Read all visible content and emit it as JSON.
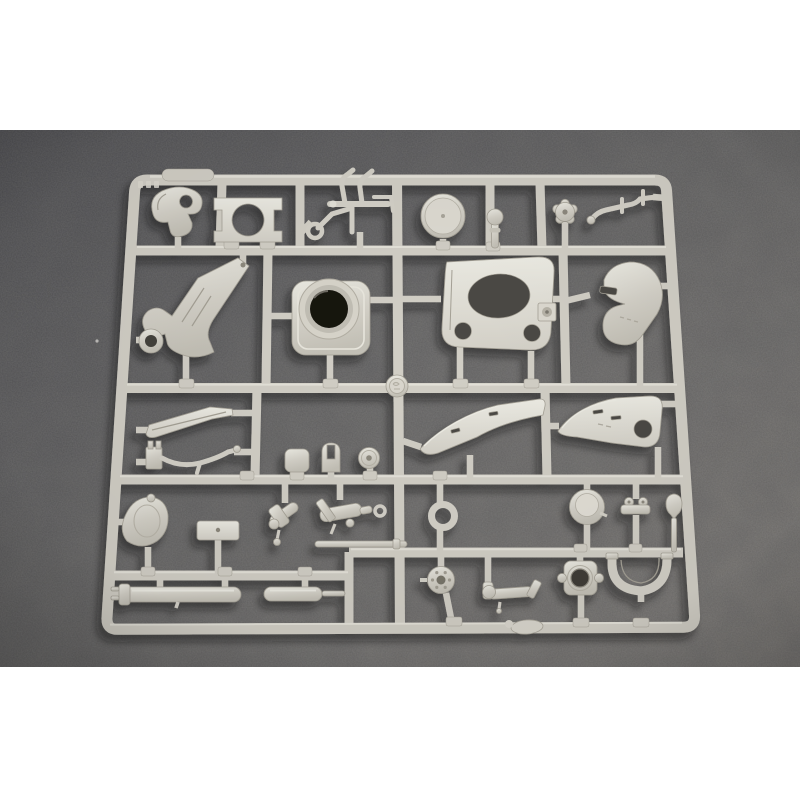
{
  "description": "Product photograph of a light grey injection-moulded plastic sprue (model kit parts tree) for a scale artillery/vehicle kit, lying on dark grey felt fabric; plain white bands above and below the photo. No readable text is visible, only an illegible embossed marking near the top-left of the frame.",
  "photo": {
    "subject": "plastic model kit sprue with unassembled parts",
    "background_material": "dark grey felt",
    "plastic_finish": "matte light grey styrene"
  },
  "colors": {
    "page_bg": "#ffffff",
    "felt_dark": "#505053",
    "felt_mid": "#696867",
    "felt_light": "#807d79",
    "plastic_hi": "#edece4",
    "plastic_base": "#d4d1c8",
    "plastic_mid": "#c4c1b7",
    "plastic_shadow": "#a5a196",
    "runner": "#d2cfc6",
    "runner_hi": "#e8e6dd",
    "hole_dark": "#181511",
    "cutout_dark": "#4b4944",
    "shadow": "#16150f"
  },
  "sprue": {
    "layout": "rectangular outer frame with one full-height centre runner, four horizontal runners and short attachment gates",
    "parts": [
      {
        "name": "molded-tab",
        "desc": "raised rounded tab on top rail",
        "cell": "top edge"
      },
      {
        "name": "molded-marking",
        "desc": "illegible embossed characters on frame",
        "cell": "top-left rail"
      },
      {
        "name": "curved-cover",
        "desc": "comma-shaped cover with round hole",
        "cell": "row1 left"
      },
      {
        "name": "ring-bracket-plate",
        "desc": "flat bracket with large circular opening",
        "cell": "row1 left-centre"
      },
      {
        "name": "cradle-rod-assembly",
        "desc": "thin rods, tubes and small ring",
        "cell": "row1 centre"
      },
      {
        "name": "road-wheel-disc",
        "desc": "plain disc wheel",
        "cell": "row1 centre-right"
      },
      {
        "name": "small-knob",
        "desc": "small stemmed knob",
        "cell": "row1 right-centre"
      },
      {
        "name": "star-knob",
        "desc": "flower/star shaped hand wheel",
        "cell": "row1 right"
      },
      {
        "name": "bent-rod",
        "desc": "cranked rod with cross pins",
        "cell": "row1 far right"
      },
      {
        "name": "trail-arm",
        "desc": "large tapered trail bracket with towing eye",
        "cell": "row2 left"
      },
      {
        "name": "turret-collar",
        "desc": "square collar with deep dark bore",
        "cell": "row2 centre-left"
      },
      {
        "name": "mount-plate",
        "desc": "plate with oval cut-out and two round holes",
        "cell": "row2 centre-right"
      },
      {
        "name": "curved-shield",
        "desc": "thick crescent shield with slot",
        "cell": "row2 right"
      },
      {
        "name": "spade-blade",
        "desc": "long tapered blade",
        "cell": "row3 left"
      },
      {
        "name": "clamp-and-tube",
        "desc": "small clamp with curved tube",
        "cell": "row3 left"
      },
      {
        "name": "square-pad",
        "desc": "rounded square pad",
        "cell": "row3 centre-left"
      },
      {
        "name": "clevis-fork",
        "desc": "forked clevis",
        "cell": "row3 centre"
      },
      {
        "name": "pulley-disc",
        "desc": "small disc with centre hole",
        "cell": "row3 centre"
      },
      {
        "name": "shield-panel-left",
        "desc": "long flat splinter-shield panel with slots",
        "cell": "row3 right of centre"
      },
      {
        "name": "shield-panel-right",
        "desc": "flat shield panel with round hole and slots",
        "cell": "row3 far right"
      },
      {
        "name": "bell-dome",
        "desc": "bell shaped dome",
        "cell": "row4 far left"
      },
      {
        "name": "mounting-plate",
        "desc": "small rectangular plate",
        "cell": "row4 left"
      },
      {
        "name": "valve-assembly-left",
        "desc": "small angled cylinder cluster",
        "cell": "row4 centre-left"
      },
      {
        "name": "valve-assembly-right",
        "desc": "breech-like cylinder with ring",
        "cell": "row4 centre"
      },
      {
        "name": "push-rod",
        "desc": "thin straight rod with collar",
        "cell": "row4 centre"
      },
      {
        "name": "towing-ring",
        "desc": "open ring",
        "cell": "row4 centre-right"
      },
      {
        "name": "dome-cap",
        "desc": "round domed cap",
        "cell": "row4 right"
      },
      {
        "name": "twin-lug-bracket",
        "desc": "bracket with two lugs",
        "cell": "row4 right"
      },
      {
        "name": "spade-grip",
        "desc": "spade shaped grip on stem",
        "cell": "row4 far right"
      },
      {
        "name": "recuperator-cylinder",
        "desc": "long cylinder with end collar",
        "cell": "row5 left"
      },
      {
        "name": "short-cylinder",
        "desc": "short cylinder with thin rod",
        "cell": "row5 centre-left"
      },
      {
        "name": "spoked-hub",
        "desc": "round hub with bolt holes",
        "cell": "row5 centre"
      },
      {
        "name": "elbow-pipe",
        "desc": "elbow pipe with flange",
        "cell": "row5 centre-right"
      },
      {
        "name": "hub-block",
        "desc": "square block with round bore and ears",
        "cell": "row5 right"
      },
      {
        "name": "curved-rocker",
        "desc": "curved rocker arc",
        "cell": "row5 far right"
      },
      {
        "name": "maker-medallion",
        "desc": "round embossed medallion at runner junction",
        "cell": "centre runner"
      },
      {
        "name": "sprue-gate-blob",
        "desc": "molten flash blob on bottom rail",
        "cell": "bottom rail"
      }
    ]
  }
}
